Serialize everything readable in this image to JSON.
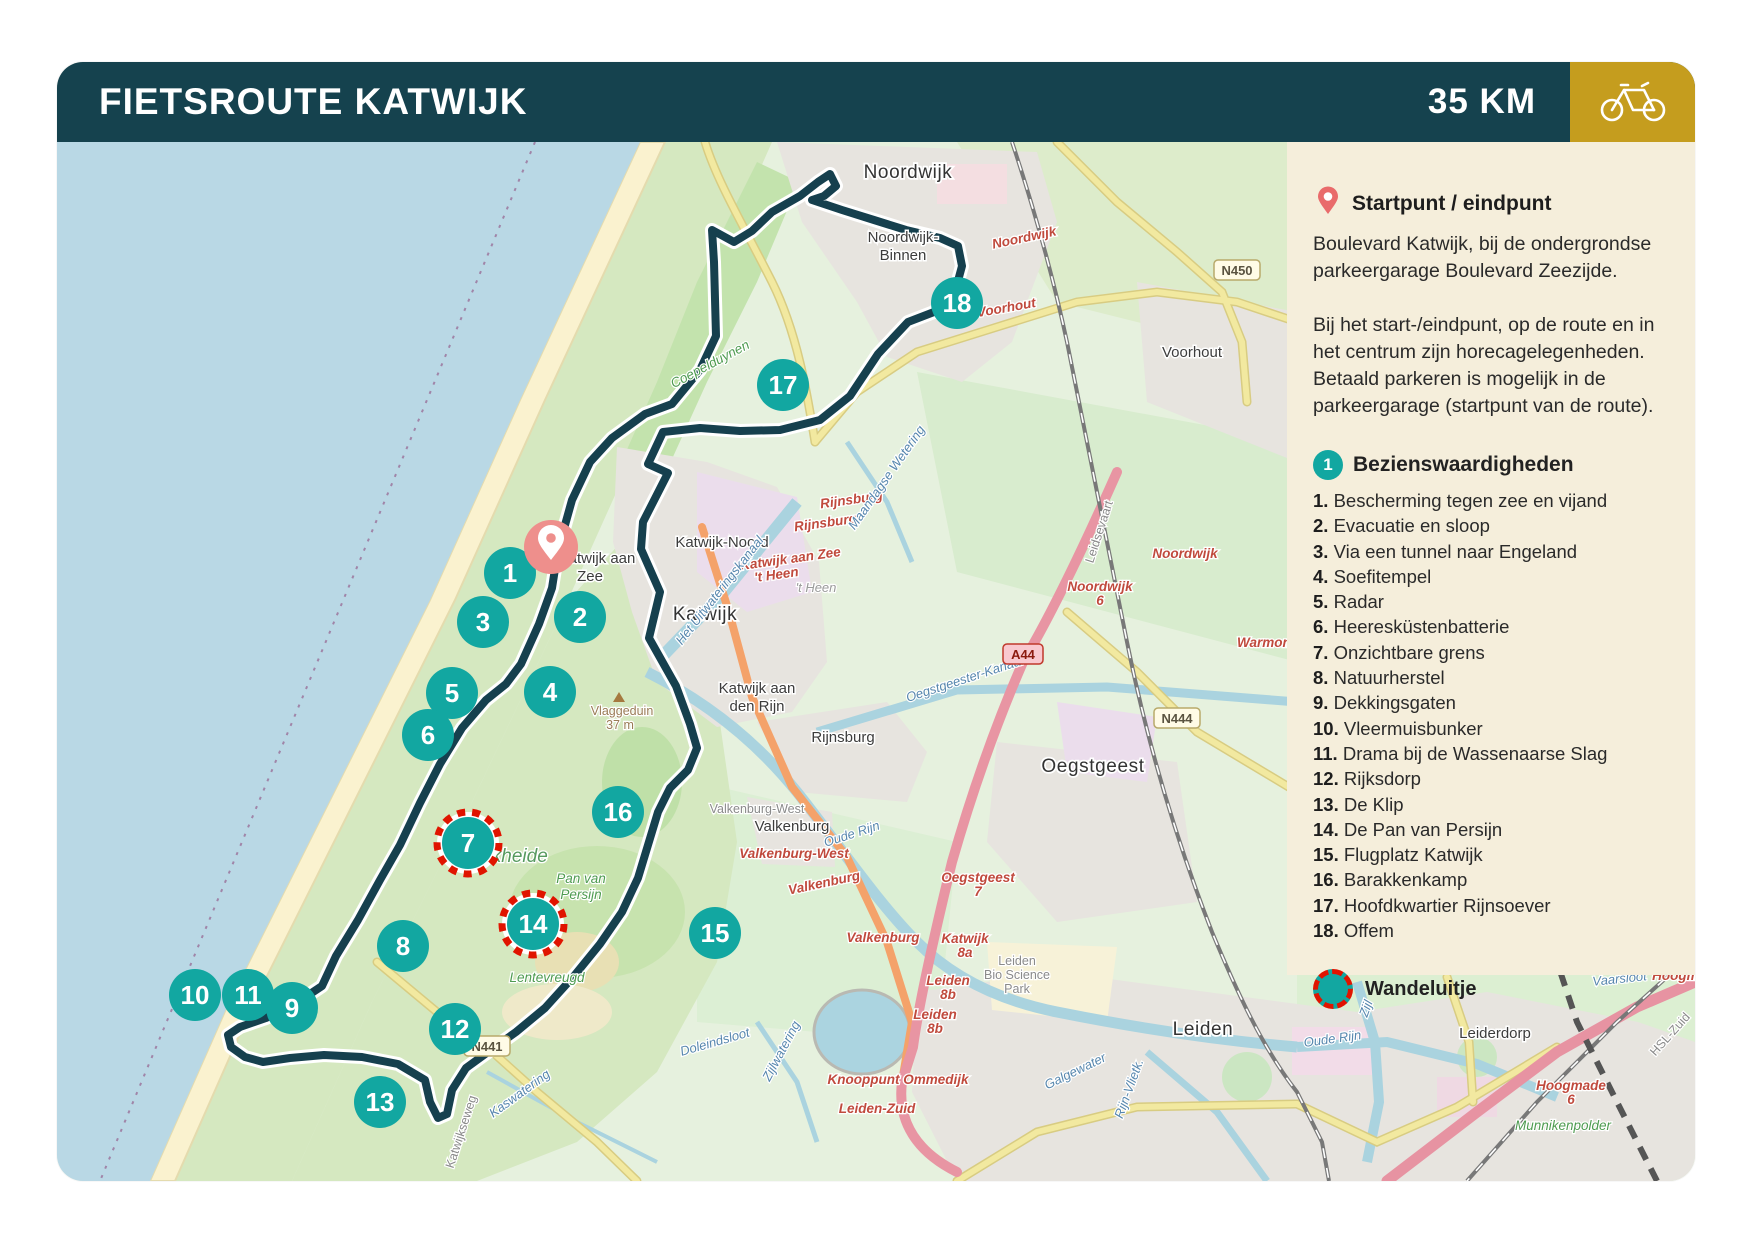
{
  "header": {
    "title": "FIETSROUTE KATWIJK",
    "distance": "35 KM",
    "bike_icon": "bicycle-icon"
  },
  "sidebar": {
    "start": {
      "icon": "location-pin-icon",
      "title": "Startpunt / eindpunt",
      "body1": "Boulevard Katwijk, bij de ondergrondse parkeergarage Boulevard Zeezijde.",
      "body2": "Bij het start-/eindpunt, op de route en in het centrum zijn horecagelegenheden. Betaald parkeren is mogelijk in de parkeergarage (startpunt van de route)."
    },
    "poi": {
      "badge": "1",
      "title": "Bezienswaardigheden",
      "items": [
        {
          "num": "1.",
          "label": "Bescherming tegen zee en vijand"
        },
        {
          "num": "2.",
          "label": "Evacuatie en sloop"
        },
        {
          "num": "3.",
          "label": "Via een tunnel naar Engeland"
        },
        {
          "num": "4.",
          "label": "Soefitempel"
        },
        {
          "num": "5.",
          "label": "Radar"
        },
        {
          "num": "6.",
          "label": "Heeresküstenbatterie"
        },
        {
          "num": "7.",
          "label": "Onzichtbare grens"
        },
        {
          "num": "8.",
          "label": "Natuurherstel"
        },
        {
          "num": "9.",
          "label": "Dekkingsgaten"
        },
        {
          "num": "10.",
          "label": "Vleermuisbunker"
        },
        {
          "num": "11.",
          "label": "Drama bij de Wassenaarse Slag"
        },
        {
          "num": "12.",
          "label": "Rijksdorp"
        },
        {
          "num": "13.",
          "label": "De Klip"
        },
        {
          "num": "14.",
          "label": "De Pan van Persijn"
        },
        {
          "num": "15.",
          "label": "Flugplatz Katwijk"
        },
        {
          "num": "16.",
          "label": "Barakkenkamp"
        },
        {
          "num": "17.",
          "label": "Hoofdkwartier Rijnsoever"
        },
        {
          "num": "18.",
          "label": "Offem"
        }
      ]
    },
    "legend": {
      "icon": "walk-loop-icon",
      "label": "Wandeluitje"
    }
  },
  "map": {
    "colors": {
      "marker": "#12a7a1",
      "ring": "#e01400",
      "pin": "#ee8f8c",
      "route": "#16404e",
      "header": "#15424e",
      "gold": "#c59d1e",
      "panel": "#f5eedb"
    },
    "start_pin": {
      "x": 494,
      "y": 405
    },
    "markers": [
      {
        "n": "1",
        "x": 453,
        "y": 431
      },
      {
        "n": "2",
        "x": 523,
        "y": 475
      },
      {
        "n": "3",
        "x": 426,
        "y": 480
      },
      {
        "n": "4",
        "x": 493,
        "y": 550
      },
      {
        "n": "5",
        "x": 395,
        "y": 551
      },
      {
        "n": "6",
        "x": 371,
        "y": 593
      },
      {
        "n": "7",
        "x": 411,
        "y": 701,
        "wandel": true
      },
      {
        "n": "8",
        "x": 346,
        "y": 804
      },
      {
        "n": "9",
        "x": 235,
        "y": 866
      },
      {
        "n": "10",
        "x": 138,
        "y": 853
      },
      {
        "n": "11",
        "x": 191,
        "y": 853
      },
      {
        "n": "12",
        "x": 398,
        "y": 887
      },
      {
        "n": "13",
        "x": 323,
        "y": 960
      },
      {
        "n": "14",
        "x": 476,
        "y": 782,
        "wandel": true
      },
      {
        "n": "15",
        "x": 658,
        "y": 791
      },
      {
        "n": "16",
        "x": 561,
        "y": 670
      },
      {
        "n": "17",
        "x": 726,
        "y": 243
      },
      {
        "n": "18",
        "x": 900,
        "y": 161
      }
    ],
    "badges": [
      {
        "text": "N450",
        "x": 1180,
        "y": 128,
        "type": "n"
      },
      {
        "text": "N444",
        "x": 1120,
        "y": 576,
        "type": "n"
      },
      {
        "text": "N441",
        "x": 430,
        "y": 904,
        "type": "n"
      },
      {
        "text": "A44",
        "x": 966,
        "y": 512,
        "type": "a"
      }
    ],
    "labels": [
      {
        "t": "Noordwijk",
        "x": 851,
        "y": 36,
        "c": "lg"
      },
      {
        "t": "Noordwijk-",
        "x": 846,
        "y": 100,
        "c": "town"
      },
      {
        "t": "Binnen",
        "x": 846,
        "y": 118,
        "c": "town"
      },
      {
        "t": "Voorhout",
        "x": 1135,
        "y": 215,
        "c": "town"
      },
      {
        "t": "Katwijk-Noord",
        "x": 665,
        "y": 405,
        "c": "town"
      },
      {
        "t": "Katwijk",
        "x": 648,
        "y": 478,
        "c": "lg"
      },
      {
        "t": "Katwijk aan",
        "x": 540,
        "y": 421,
        "c": "town"
      },
      {
        "t": "Zee",
        "x": 533,
        "y": 439,
        "c": "town"
      },
      {
        "t": "Katwijk aan",
        "x": 700,
        "y": 551,
        "c": "town"
      },
      {
        "t": "den Rijn",
        "x": 700,
        "y": 569,
        "c": "town"
      },
      {
        "t": "Rijnsburg",
        "x": 786,
        "y": 600,
        "c": "town"
      },
      {
        "t": "Oegstgeest",
        "x": 1036,
        "y": 630,
        "c": "lg"
      },
      {
        "t": "Valkenburg",
        "x": 735,
        "y": 689,
        "c": "town"
      },
      {
        "t": "Valkenburg-West",
        "x": 700,
        "y": 671,
        "c": "gray"
      },
      {
        "t": "Leiden",
        "x": 1146,
        "y": 893,
        "c": "lg"
      },
      {
        "t": "Leiderdorp",
        "x": 1438,
        "y": 896,
        "c": "town"
      },
      {
        "t": "'t Heen",
        "x": 759,
        "y": 450,
        "c": "gray-i"
      },
      {
        "t": "Noordwijk",
        "x": 968,
        "y": 100,
        "c": "red",
        "r": -12
      },
      {
        "t": "Voorhout",
        "x": 950,
        "y": 170,
        "c": "red",
        "r": -10
      },
      {
        "t": "Noordwijk",
        "x": 1128,
        "y": 416,
        "c": "red"
      },
      {
        "t": "Noordwijk",
        "x": 1043,
        "y": 449,
        "c": "red"
      },
      {
        "t": "6",
        "x": 1043,
        "y": 463,
        "c": "red"
      },
      {
        "t": "Warmond",
        "x": 1211,
        "y": 505,
        "c": "red"
      },
      {
        "t": "Rijnsburg",
        "x": 795,
        "y": 362,
        "c": "red",
        "r": -8
      },
      {
        "t": "Rijnsburg",
        "x": 769,
        "y": 385,
        "c": "red",
        "r": -8
      },
      {
        "t": "Katwijk aan Zee",
        "x": 734,
        "y": 421,
        "c": "red",
        "r": -8
      },
      {
        "t": "'t Heen",
        "x": 720,
        "y": 437,
        "c": "red",
        "r": -8
      },
      {
        "t": "Valkenburg-West",
        "x": 737,
        "y": 716,
        "c": "red"
      },
      {
        "t": "Valkenburg",
        "x": 768,
        "y": 745,
        "c": "red",
        "r": -12
      },
      {
        "t": "Valkenburg",
        "x": 826,
        "y": 800,
        "c": "red"
      },
      {
        "t": "Oegstgeest",
        "x": 921,
        "y": 740,
        "c": "red"
      },
      {
        "t": "7",
        "x": 921,
        "y": 754,
        "c": "red"
      },
      {
        "t": "Katwijk",
        "x": 908,
        "y": 801,
        "c": "red"
      },
      {
        "t": "8a",
        "x": 908,
        "y": 815,
        "c": "red"
      },
      {
        "t": "Leiden",
        "x": 891,
        "y": 843,
        "c": "red"
      },
      {
        "t": "8b",
        "x": 891,
        "y": 857,
        "c": "red"
      },
      {
        "t": "Leiden",
        "x": 878,
        "y": 877,
        "c": "red"
      },
      {
        "t": "8b",
        "x": 878,
        "y": 891,
        "c": "red"
      },
      {
        "t": "Knooppunt Ommedijk",
        "x": 841,
        "y": 942,
        "c": "red"
      },
      {
        "t": "Leiden-Zuid",
        "x": 820,
        "y": 971,
        "c": "red"
      },
      {
        "t": "Hoogmade",
        "x": 1514,
        "y": 948,
        "c": "red"
      },
      {
        "t": "6",
        "x": 1514,
        "y": 962,
        "c": "red"
      },
      {
        "t": "Hoogmade",
        "x": 1630,
        "y": 838,
        "c": "red"
      },
      {
        "t": "Maandagse Wetering",
        "x": 833,
        "y": 338,
        "c": "blue",
        "r": -55
      },
      {
        "t": "Het Uitwateringskanaal",
        "x": 666,
        "y": 451,
        "c": "blue",
        "r": -52
      },
      {
        "t": "Oegstgeester-Kanaal",
        "x": 909,
        "y": 541,
        "c": "blue",
        "r": -18
      },
      {
        "t": "Oude Rijn",
        "x": 796,
        "y": 696,
        "c": "blue",
        "r": -18
      },
      {
        "t": "Oude Rijn",
        "x": 1276,
        "y": 901,
        "c": "blue",
        "r": -8
      },
      {
        "t": "Zijl",
        "x": 1313,
        "y": 868,
        "c": "blue",
        "r": -70
      },
      {
        "t": "Doleindsloot",
        "x": 659,
        "y": 904,
        "c": "blue",
        "r": -16
      },
      {
        "t": "Zijlwatering",
        "x": 728,
        "y": 911,
        "c": "blue",
        "r": -62
      },
      {
        "t": "Kaswatering",
        "x": 465,
        "y": 955,
        "c": "blue",
        "r": -36
      },
      {
        "t": "Galgewater",
        "x": 1020,
        "y": 933,
        "c": "blue",
        "r": -26
      },
      {
        "t": "Rijn-Vlietk.",
        "x": 1076,
        "y": 948,
        "c": "blue",
        "r": -70
      },
      {
        "t": "Vaarsloot",
        "x": 1563,
        "y": 841,
        "c": "blue",
        "r": -6
      },
      {
        "t": "Coepelduynen",
        "x": 655,
        "y": 226,
        "c": "green",
        "r": -28
      },
      {
        "t": "Berkheide",
        "x": 448,
        "y": 720,
        "c": "green-lg"
      },
      {
        "t": "Pan van",
        "x": 524,
        "y": 741,
        "c": "green"
      },
      {
        "t": "Persijn",
        "x": 524,
        "y": 757,
        "c": "green"
      },
      {
        "t": "Lentevreugd",
        "x": 490,
        "y": 840,
        "c": "green"
      },
      {
        "t": "Munnikenpolder",
        "x": 1506,
        "y": 988,
        "c": "green"
      },
      {
        "t": "Leidsevaart",
        "x": 1046,
        "y": 391,
        "c": "gray",
        "r": -72
      },
      {
        "t": "Leiden",
        "x": 960,
        "y": 823,
        "c": "gray"
      },
      {
        "t": "Bio Science",
        "x": 960,
        "y": 837,
        "c": "gray"
      },
      {
        "t": "Park",
        "x": 960,
        "y": 851,
        "c": "gray"
      },
      {
        "t": "HSL-Zuid",
        "x": 1616,
        "y": 895,
        "c": "gray",
        "r": -48
      },
      {
        "t": "Katwijkseweg",
        "x": 408,
        "y": 991,
        "c": "gray",
        "r": -72
      },
      {
        "t": "Vlaggeduin",
        "x": 565,
        "y": 573,
        "c": "brown"
      },
      {
        "t": "37 m",
        "x": 563,
        "y": 587,
        "c": "brown"
      }
    ]
  }
}
